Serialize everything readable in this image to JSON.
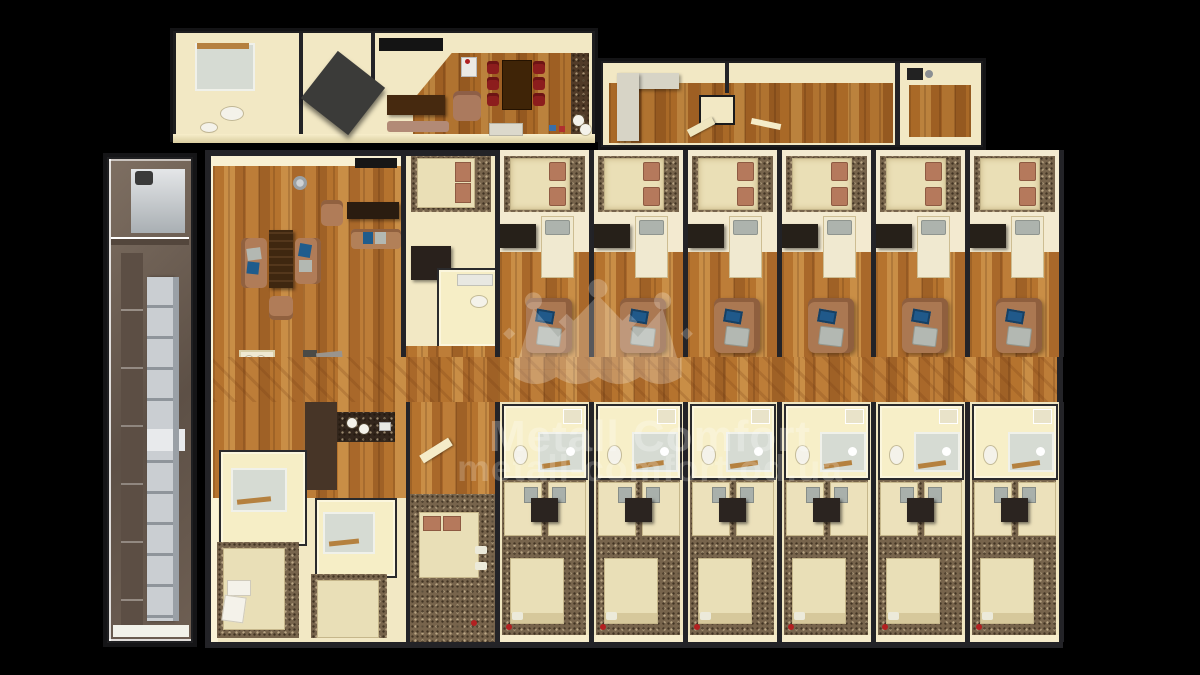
{
  "watermark": {
    "title": "Metall Comfort",
    "url": "metall-comfort.od.ua",
    "logo": "crown-icon",
    "text_color": "#ffffff",
    "title_opacity": 0.26,
    "url_opacity": 0.2
  },
  "floorplan": {
    "guest_rooms_top_row": 6,
    "guest_rooms_bottom_row": 6,
    "dining_chairs": 6,
    "palette": {
      "background": "#000000",
      "wall_dark": "#232327",
      "wall_cream": "#f2e8c4",
      "floor_wood": "#b5732e",
      "floor_carpet": "#77644c",
      "bed_linen": "#ece1bb",
      "pillow_brown": "#b5795c",
      "pillow_gray": "#adb3ad",
      "sofa_brown": "#ab7852",
      "furniture_dark": "#2b2420",
      "dining_chair_red": "#8c1d1d",
      "dining_table_brown": "#3f2407",
      "stairs_gray": "#c8cbcf",
      "stairwell_brown": "#6e5f53",
      "counter_white": "#d7d4c6",
      "laptop_blue": "#20598a"
    }
  }
}
